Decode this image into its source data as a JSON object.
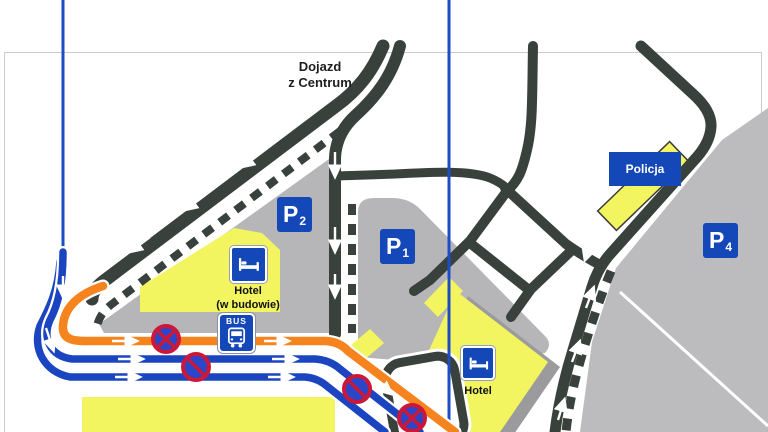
{
  "labels": {
    "access_road": {
      "lines": [
        "Dojazd",
        "z Centrum"
      ]
    },
    "street": "Żwirki i Wigury"
  },
  "parking_signs": [
    {
      "id": "P2",
      "letter": "P",
      "number": "2"
    },
    {
      "id": "P1",
      "letter": "P",
      "number": "1"
    },
    {
      "id": "P4",
      "letter": "P",
      "number": "4"
    }
  ],
  "buildings": {
    "hotel_under_construction": {
      "icon": "bed-icon",
      "lines": [
        "Hotel",
        "(w budowie)"
      ]
    },
    "hotel": {
      "icon": "bed-icon",
      "label": "Hotel"
    },
    "police": {
      "sign_label": "Policja"
    }
  },
  "transit": {
    "bus_stop_label": "BUS"
  },
  "prohibition_signs": [
    {
      "type": "no-stopping"
    },
    {
      "type": "no-parking"
    },
    {
      "type": "no-parking"
    },
    {
      "type": "no-stopping"
    }
  ],
  "colors": {
    "road": "#39413d",
    "area_gray": "#b6b6b8",
    "area_gray_light": "#bcbcbe",
    "shadow_gray": "#9b9b9d",
    "building_yellow": "#f2f560",
    "sign_blue": "#1448b8",
    "route_orange": "#f5831e",
    "route_blue": "#1b45c0",
    "guide_line_blue": "#1d4dc4",
    "prohibit_red": "#cc1838",
    "prohibit_blue": "#2b46c8",
    "frame_gray": "#cbcbcb"
  }
}
